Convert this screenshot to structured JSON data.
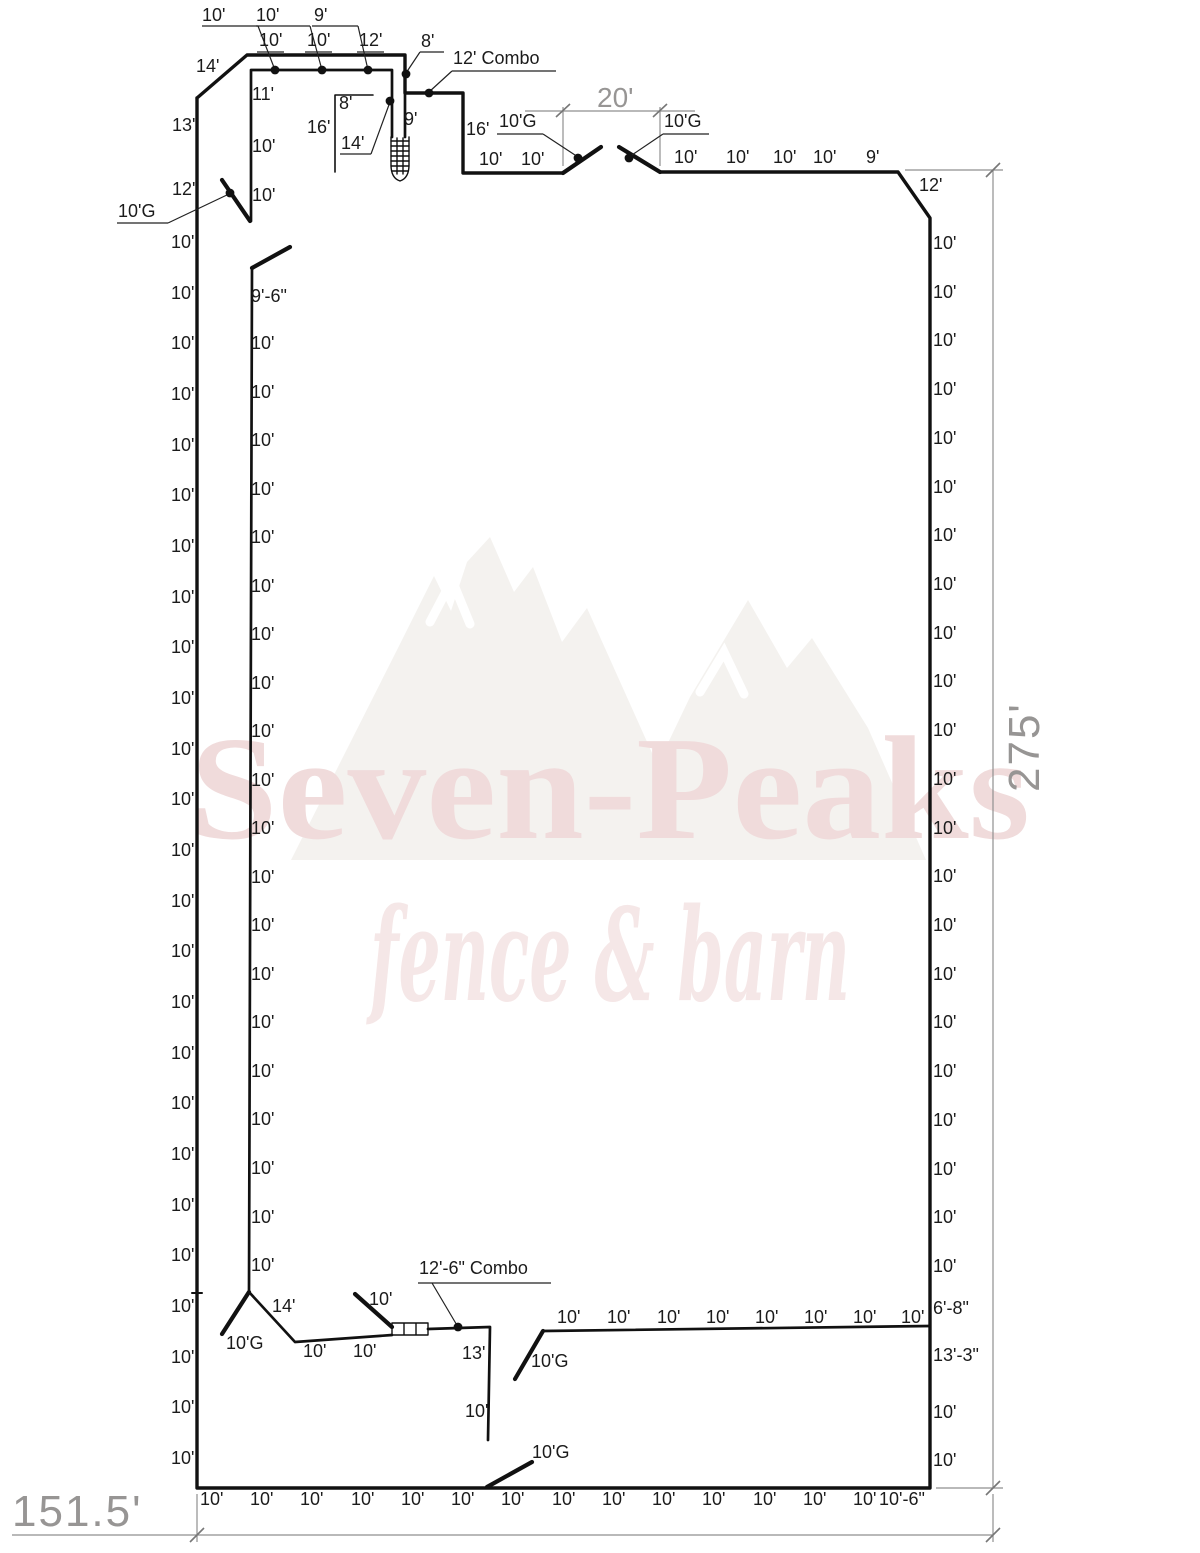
{
  "watermark": {
    "brand": "Seven-Peaks",
    "tagline": "fence & barn"
  },
  "dimensions": {
    "width": "151.5'",
    "height": "275'",
    "gate_opening": "20'"
  },
  "labels": [
    {
      "n": "leader-label",
      "t": "10'",
      "x": 202,
      "y": 6
    },
    {
      "n": "leader-label",
      "t": "10'",
      "x": 256,
      "y": 6
    },
    {
      "n": "leader-label",
      "t": "9'",
      "x": 314,
      "y": 6
    },
    {
      "n": "panel-label",
      "t": "10'",
      "x": 259,
      "y": 31
    },
    {
      "n": "panel-label",
      "t": "10'",
      "x": 307,
      "y": 31
    },
    {
      "n": "panel-label",
      "t": "12'",
      "x": 359,
      "y": 31
    },
    {
      "n": "panel-label",
      "t": "14'",
      "x": 196,
      "y": 57
    },
    {
      "n": "leader-label",
      "t": "8'",
      "x": 421,
      "y": 32
    },
    {
      "n": "leader-label",
      "t": "12' Combo",
      "x": 453,
      "y": 49
    },
    {
      "n": "panel-label",
      "t": "13'",
      "x": 172,
      "y": 116
    },
    {
      "n": "panel-label",
      "t": "12'",
      "x": 172,
      "y": 180
    },
    {
      "n": "panel-label",
      "t": "11'",
      "x": 252,
      "y": 85
    },
    {
      "n": "panel-label",
      "t": "10'",
      "x": 252,
      "y": 137
    },
    {
      "n": "panel-label",
      "t": "10'",
      "x": 252,
      "y": 186
    },
    {
      "n": "panel-label",
      "t": "8'",
      "x": 339,
      "y": 94
    },
    {
      "n": "panel-label",
      "t": "16'",
      "x": 307,
      "y": 118
    },
    {
      "n": "leader-label",
      "t": "14'",
      "x": 341,
      "y": 134
    },
    {
      "n": "panel-label",
      "t": "9'",
      "x": 404,
      "y": 110
    },
    {
      "n": "panel-label",
      "t": "16'",
      "x": 466,
      "y": 120
    },
    {
      "n": "panel-label",
      "t": "10'",
      "x": 479,
      "y": 150
    },
    {
      "n": "panel-label",
      "t": "10'",
      "x": 521,
      "y": 150
    },
    {
      "n": "gate-label",
      "t": "10'G",
      "x": 499,
      "y": 112
    },
    {
      "n": "gate-label",
      "t": "10'G",
      "x": 664,
      "y": 112
    },
    {
      "n": "panel-label",
      "t": "10'",
      "x": 674,
      "y": 148
    },
    {
      "n": "panel-label",
      "t": "10'",
      "x": 726,
      "y": 148
    },
    {
      "n": "panel-label",
      "t": "10'",
      "x": 773,
      "y": 148
    },
    {
      "n": "panel-label",
      "t": "10'",
      "x": 813,
      "y": 148
    },
    {
      "n": "panel-label",
      "t": "9'",
      "x": 866,
      "y": 148
    },
    {
      "n": "panel-label",
      "t": "12'",
      "x": 919,
      "y": 176
    },
    {
      "n": "gate-label",
      "t": "10'G",
      "x": 118,
      "y": 202
    },
    {
      "n": "left-panel-label",
      "t": "10'",
      "x": 171,
      "y": 233
    },
    {
      "n": "left-panel-label",
      "t": "10'",
      "x": 171,
      "y": 284
    },
    {
      "n": "left-panel-label",
      "t": "10'",
      "x": 171,
      "y": 334
    },
    {
      "n": "left-panel-label",
      "t": "10'",
      "x": 171,
      "y": 385
    },
    {
      "n": "left-panel-label",
      "t": "10'",
      "x": 171,
      "y": 436
    },
    {
      "n": "left-panel-label",
      "t": "10'",
      "x": 171,
      "y": 486
    },
    {
      "n": "left-panel-label",
      "t": "10'",
      "x": 171,
      "y": 537
    },
    {
      "n": "left-panel-label",
      "t": "10'",
      "x": 171,
      "y": 588
    },
    {
      "n": "left-panel-label",
      "t": "10'",
      "x": 171,
      "y": 638
    },
    {
      "n": "left-panel-label",
      "t": "10'",
      "x": 171,
      "y": 689
    },
    {
      "n": "left-panel-label",
      "t": "10'",
      "x": 171,
      "y": 740
    },
    {
      "n": "left-panel-label",
      "t": "10'",
      "x": 171,
      "y": 790
    },
    {
      "n": "left-panel-label",
      "t": "10'",
      "x": 171,
      "y": 841
    },
    {
      "n": "left-panel-label",
      "t": "10'",
      "x": 171,
      "y": 892
    },
    {
      "n": "left-panel-label",
      "t": "10'",
      "x": 171,
      "y": 942
    },
    {
      "n": "left-panel-label",
      "t": "10'",
      "x": 171,
      "y": 993
    },
    {
      "n": "left-panel-label",
      "t": "10'",
      "x": 171,
      "y": 1044
    },
    {
      "n": "left-panel-label",
      "t": "10'",
      "x": 171,
      "y": 1094
    },
    {
      "n": "left-panel-label",
      "t": "10'",
      "x": 171,
      "y": 1145
    },
    {
      "n": "left-panel-label",
      "t": "10'",
      "x": 171,
      "y": 1196
    },
    {
      "n": "left-panel-label",
      "t": "10'",
      "x": 171,
      "y": 1246
    },
    {
      "n": "left-panel-label",
      "t": "10'",
      "x": 171,
      "y": 1297
    },
    {
      "n": "left-panel-label",
      "t": "10'",
      "x": 171,
      "y": 1348
    },
    {
      "n": "left-panel-label",
      "t": "10'",
      "x": 171,
      "y": 1398
    },
    {
      "n": "left-panel-label",
      "t": "10'",
      "x": 171,
      "y": 1449
    },
    {
      "n": "inner-panel-label",
      "t": "9'-6\"",
      "x": 251,
      "y": 287
    },
    {
      "n": "inner-panel-label",
      "t": "10'",
      "x": 251,
      "y": 334
    },
    {
      "n": "inner-panel-label",
      "t": "10'",
      "x": 251,
      "y": 383
    },
    {
      "n": "inner-panel-label",
      "t": "10'",
      "x": 251,
      "y": 431
    },
    {
      "n": "inner-panel-label",
      "t": "10'",
      "x": 251,
      "y": 480
    },
    {
      "n": "inner-panel-label",
      "t": "10'",
      "x": 251,
      "y": 528
    },
    {
      "n": "inner-panel-label",
      "t": "10'",
      "x": 251,
      "y": 577
    },
    {
      "n": "inner-panel-label",
      "t": "10'",
      "x": 251,
      "y": 625
    },
    {
      "n": "inner-panel-label",
      "t": "10'",
      "x": 251,
      "y": 674
    },
    {
      "n": "inner-panel-label",
      "t": "10'",
      "x": 251,
      "y": 722
    },
    {
      "n": "inner-panel-label",
      "t": "10'",
      "x": 251,
      "y": 771
    },
    {
      "n": "inner-panel-label",
      "t": "10'",
      "x": 251,
      "y": 819
    },
    {
      "n": "inner-panel-label",
      "t": "10'",
      "x": 251,
      "y": 868
    },
    {
      "n": "inner-panel-label",
      "t": "10'",
      "x": 251,
      "y": 916
    },
    {
      "n": "inner-panel-label",
      "t": "10'",
      "x": 251,
      "y": 965
    },
    {
      "n": "inner-panel-label",
      "t": "10'",
      "x": 251,
      "y": 1013
    },
    {
      "n": "inner-panel-label",
      "t": "10'",
      "x": 251,
      "y": 1062
    },
    {
      "n": "inner-panel-label",
      "t": "10'",
      "x": 251,
      "y": 1110
    },
    {
      "n": "inner-panel-label",
      "t": "10'",
      "x": 251,
      "y": 1159
    },
    {
      "n": "inner-panel-label",
      "t": "10'",
      "x": 251,
      "y": 1208
    },
    {
      "n": "inner-panel-label",
      "t": "10'",
      "x": 251,
      "y": 1256
    },
    {
      "n": "right-panel-label",
      "t": "10'",
      "x": 933,
      "y": 234
    },
    {
      "n": "right-panel-label",
      "t": "10'",
      "x": 933,
      "y": 283
    },
    {
      "n": "right-panel-label",
      "t": "10'",
      "x": 933,
      "y": 331
    },
    {
      "n": "right-panel-label",
      "t": "10'",
      "x": 933,
      "y": 380
    },
    {
      "n": "right-panel-label",
      "t": "10'",
      "x": 933,
      "y": 429
    },
    {
      "n": "right-panel-label",
      "t": "10'",
      "x": 933,
      "y": 478
    },
    {
      "n": "right-panel-label",
      "t": "10'",
      "x": 933,
      "y": 526
    },
    {
      "n": "right-panel-label",
      "t": "10'",
      "x": 933,
      "y": 575
    },
    {
      "n": "right-panel-label",
      "t": "10'",
      "x": 933,
      "y": 624
    },
    {
      "n": "right-panel-label",
      "t": "10'",
      "x": 933,
      "y": 672
    },
    {
      "n": "right-panel-label",
      "t": "10'",
      "x": 933,
      "y": 721
    },
    {
      "n": "right-panel-label",
      "t": "10'",
      "x": 933,
      "y": 770
    },
    {
      "n": "right-panel-label",
      "t": "10'",
      "x": 933,
      "y": 819
    },
    {
      "n": "right-panel-label",
      "t": "10'",
      "x": 933,
      "y": 867
    },
    {
      "n": "right-panel-label",
      "t": "10'",
      "x": 933,
      "y": 916
    },
    {
      "n": "right-panel-label",
      "t": "10'",
      "x": 933,
      "y": 965
    },
    {
      "n": "right-panel-label",
      "t": "10'",
      "x": 933,
      "y": 1013
    },
    {
      "n": "right-panel-label",
      "t": "10'",
      "x": 933,
      "y": 1062
    },
    {
      "n": "right-panel-label",
      "t": "10'",
      "x": 933,
      "y": 1111
    },
    {
      "n": "right-panel-label",
      "t": "10'",
      "x": 933,
      "y": 1160
    },
    {
      "n": "right-panel-label",
      "t": "10'",
      "x": 933,
      "y": 1208
    },
    {
      "n": "right-panel-label",
      "t": "10'",
      "x": 933,
      "y": 1257
    },
    {
      "n": "right-panel-label",
      "t": "6'-8\"",
      "x": 933,
      "y": 1299
    },
    {
      "n": "right-panel-label",
      "t": "13'-3\"",
      "x": 933,
      "y": 1346
    },
    {
      "n": "right-panel-label",
      "t": "10'",
      "x": 933,
      "y": 1403
    },
    {
      "n": "right-panel-label",
      "t": "10'",
      "x": 933,
      "y": 1451
    },
    {
      "n": "bottom-panel-label",
      "t": "10'",
      "x": 200,
      "y": 1490
    },
    {
      "n": "bottom-panel-label",
      "t": "10'",
      "x": 250,
      "y": 1490
    },
    {
      "n": "bottom-panel-label",
      "t": "10'",
      "x": 300,
      "y": 1490
    },
    {
      "n": "bottom-panel-label",
      "t": "10'",
      "x": 351,
      "y": 1490
    },
    {
      "n": "bottom-panel-label",
      "t": "10'",
      "x": 401,
      "y": 1490
    },
    {
      "n": "bottom-panel-label",
      "t": "10'",
      "x": 451,
      "y": 1490
    },
    {
      "n": "bottom-panel-label",
      "t": "10'",
      "x": 501,
      "y": 1490
    },
    {
      "n": "bottom-panel-label",
      "t": "10'",
      "x": 552,
      "y": 1490
    },
    {
      "n": "bottom-panel-label",
      "t": "10'",
      "x": 602,
      "y": 1490
    },
    {
      "n": "bottom-panel-label",
      "t": "10'",
      "x": 652,
      "y": 1490
    },
    {
      "n": "bottom-panel-label",
      "t": "10'",
      "x": 702,
      "y": 1490
    },
    {
      "n": "bottom-panel-label",
      "t": "10'",
      "x": 753,
      "y": 1490
    },
    {
      "n": "bottom-panel-label",
      "t": "10'",
      "x": 803,
      "y": 1490
    },
    {
      "n": "bottom-panel-label",
      "t": "10'",
      "x": 853,
      "y": 1490
    },
    {
      "n": "bottom-panel-label",
      "t": "10'-6\"",
      "x": 879,
      "y": 1490
    },
    {
      "n": "panel-label",
      "t": "14'",
      "x": 272,
      "y": 1297
    },
    {
      "n": "gate-label",
      "t": "10'G",
      "x": 226,
      "y": 1334
    },
    {
      "n": "panel-label",
      "t": "10'",
      "x": 303,
      "y": 1342
    },
    {
      "n": "panel-label",
      "t": "10'",
      "x": 353,
      "y": 1342
    },
    {
      "n": "gate-label",
      "t": "10'",
      "x": 369,
      "y": 1290
    },
    {
      "n": "leader-label",
      "t": "12'-6\" Combo",
      "x": 419,
      "y": 1259
    },
    {
      "n": "panel-label",
      "t": "13'",
      "x": 462,
      "y": 1344
    },
    {
      "n": "panel-label",
      "t": "10'",
      "x": 465,
      "y": 1402
    },
    {
      "n": "gate-label",
      "t": "10'G",
      "x": 531,
      "y": 1352
    },
    {
      "n": "inner-bottom-panel-label",
      "t": "10'",
      "x": 557,
      "y": 1308
    },
    {
      "n": "inner-bottom-panel-label",
      "t": "10'",
      "x": 607,
      "y": 1308
    },
    {
      "n": "inner-bottom-panel-label",
      "t": "10'",
      "x": 657,
      "y": 1308
    },
    {
      "n": "inner-bottom-panel-label",
      "t": "10'",
      "x": 706,
      "y": 1308
    },
    {
      "n": "inner-bottom-panel-label",
      "t": "10'",
      "x": 755,
      "y": 1308
    },
    {
      "n": "inner-bottom-panel-label",
      "t": "10'",
      "x": 804,
      "y": 1308
    },
    {
      "n": "inner-bottom-panel-label",
      "t": "10'",
      "x": 853,
      "y": 1308
    },
    {
      "n": "inner-bottom-panel-label",
      "t": "10'",
      "x": 901,
      "y": 1308
    },
    {
      "n": "gate-label",
      "t": "10'G",
      "x": 532,
      "y": 1443
    }
  ]
}
